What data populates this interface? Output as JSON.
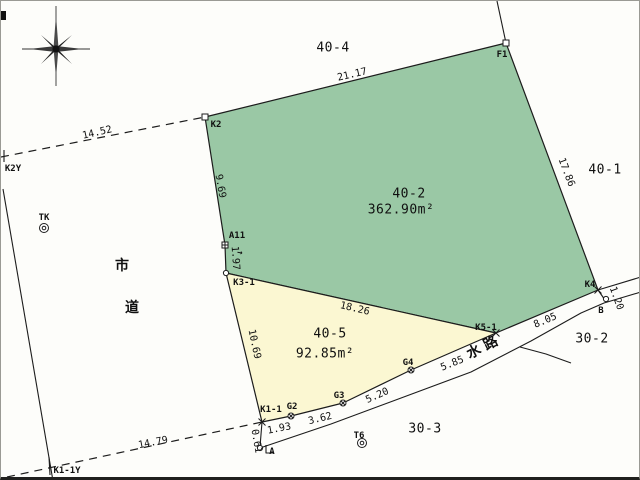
{
  "map": {
    "type_note": "cadastral survey plat",
    "colors": {
      "parcel_green": "#9ac8a5",
      "parcel_yellow": "#fbf7d2",
      "line": "#1c1c1c",
      "paper": "#fdfdfa"
    },
    "compass": {
      "cx": 55,
      "cy": 47
    },
    "parcels": [
      {
        "name": "parcel-40-2",
        "id_label": "40-2",
        "area": "362.90m²",
        "fill": "#9ac8a5",
        "points": [
          [
            204,
            116
          ],
          [
            505,
            42
          ],
          [
            597,
            289
          ],
          [
            495,
            332
          ],
          [
            225,
            272
          ],
          [
            224,
            244
          ]
        ]
      },
      {
        "name": "parcel-40-5",
        "id_label": "40-5",
        "area": "92.85m²",
        "fill": "#fbf7d2",
        "points": [
          [
            225,
            272
          ],
          [
            495,
            332
          ],
          [
            410,
            369
          ],
          [
            342,
            402
          ],
          [
            290,
            415
          ],
          [
            261,
            421
          ]
        ]
      }
    ],
    "dashed_lines": [
      {
        "name": "road-boundary-north-dashed",
        "pts": [
          [
            0,
            156
          ],
          [
            204,
            116
          ]
        ]
      },
      {
        "name": "road-boundary-south-dashed",
        "pts": [
          [
            6,
            476
          ],
          [
            261,
            421
          ]
        ]
      }
    ],
    "solid_lines": [
      {
        "name": "f1-stem-line",
        "pts": [
          [
            505,
            42
          ],
          [
            496,
            0
          ]
        ]
      },
      {
        "name": "road-left-edge",
        "pts": [
          [
            2,
            188
          ],
          [
            52,
            480
          ]
        ]
      },
      {
        "name": "waterway-top-bank-extension",
        "pts": [
          [
            597,
            289
          ],
          [
            640,
            276
          ]
        ]
      },
      {
        "name": "waterway-bottom-bank",
        "pts": [
          [
            259,
            447
          ],
          [
            330,
            423
          ],
          [
            392,
            400
          ],
          [
            470,
            371
          ],
          [
            530,
            340
          ],
          [
            580,
            312
          ],
          [
            603,
            302
          ],
          [
            640,
            291
          ]
        ]
      },
      {
        "name": "k4-to-b-segment",
        "pts": [
          [
            597,
            289
          ],
          [
            604,
            299
          ]
        ]
      },
      {
        "name": "k1-1-to-a-segment",
        "pts": [
          [
            261,
            421
          ],
          [
            259,
            446
          ]
        ]
      },
      {
        "name": "boundary-branch-30-2-30-3",
        "pts": [
          [
            519,
            346
          ],
          [
            545,
            353
          ],
          [
            570,
            362
          ]
        ]
      },
      {
        "name": "k1-1y-tick",
        "pts": [
          [
            48,
            456
          ],
          [
            49,
            474
          ]
        ]
      },
      {
        "name": "k2y-tick",
        "pts": [
          [
            3,
            149
          ],
          [
            3,
            161
          ]
        ]
      },
      {
        "name": "a-corner-bracket",
        "pts": [
          [
            265,
            444
          ],
          [
            265,
            452
          ],
          [
            272,
            452
          ]
        ]
      }
    ],
    "points": [
      {
        "name": "point-K2",
        "marker": "square",
        "x": 204,
        "y": 116
      },
      {
        "name": "point-F1",
        "marker": "square",
        "x": 505,
        "y": 42
      },
      {
        "name": "point-A11",
        "marker": "square-cross",
        "x": 224,
        "y": 244
      },
      {
        "name": "point-K3-1",
        "marker": "circle",
        "x": 225,
        "y": 272
      },
      {
        "name": "point-K4",
        "marker": "x",
        "x": 597,
        "y": 289
      },
      {
        "name": "point-K5-1",
        "marker": "x",
        "x": 495,
        "y": 332
      },
      {
        "name": "point-K1-1",
        "marker": "x",
        "x": 261,
        "y": 421
      },
      {
        "name": "point-A",
        "marker": "circle",
        "x": 259,
        "y": 447
      },
      {
        "name": "point-B",
        "marker": "circle",
        "x": 605,
        "y": 298
      },
      {
        "name": "point-G2",
        "marker": "circle-x",
        "x": 290,
        "y": 415
      },
      {
        "name": "point-G3",
        "marker": "circle-x",
        "x": 342,
        "y": 402
      },
      {
        "name": "point-G4",
        "marker": "circle-x",
        "x": 410,
        "y": 369
      },
      {
        "name": "point-TK",
        "marker": "double-circle",
        "x": 43,
        "y": 227
      },
      {
        "name": "point-T6",
        "marker": "double-circle",
        "x": 361,
        "y": 442
      }
    ],
    "labels": [
      {
        "name": "parcel-label-40-4",
        "cls": "parcel",
        "text": "40-4",
        "x": 332,
        "y": 46,
        "rot": 0
      },
      {
        "name": "distance-21-17",
        "cls": "dist",
        "text": "21.17",
        "x": 351,
        "y": 73,
        "rot": -13
      },
      {
        "name": "point-label-f1",
        "cls": "pt",
        "text": "F1",
        "x": 501,
        "y": 53,
        "rot": 0
      },
      {
        "name": "distance-17-86",
        "cls": "dist",
        "text": "17.86",
        "x": 566,
        "y": 171,
        "rot": 69
      },
      {
        "name": "parcel-label-40-1",
        "cls": "parcel",
        "text": "40-1",
        "x": 604,
        "y": 168,
        "rot": 0
      },
      {
        "name": "distance-14-52",
        "cls": "dist",
        "text": "14.52",
        "x": 96,
        "y": 131,
        "rot": -13
      },
      {
        "name": "point-label-k2y",
        "cls": "pt",
        "text": "K2Y",
        "x": 12,
        "y": 167,
        "rot": 0
      },
      {
        "name": "point-label-k2",
        "cls": "pt",
        "text": "K2",
        "x": 215,
        "y": 123,
        "rot": 0
      },
      {
        "name": "distance-9-69",
        "cls": "dist",
        "text": "9.69",
        "x": 220,
        "y": 185,
        "rot": 80
      },
      {
        "name": "point-label-a11",
        "cls": "pt",
        "text": "A11",
        "x": 236,
        "y": 234,
        "rot": 0
      },
      {
        "name": "direction-arrow",
        "cls": "pt",
        "text": "→",
        "x": 239,
        "y": 251,
        "rot": 10
      },
      {
        "name": "distance-1-97",
        "cls": "dist",
        "text": "1.97",
        "x": 235,
        "y": 257,
        "rot": 86
      },
      {
        "name": "point-label-k3-1",
        "cls": "pt",
        "text": "K3-1",
        "x": 243,
        "y": 281,
        "rot": 0
      },
      {
        "name": "point-label-tk",
        "cls": "pt",
        "text": "TK",
        "x": 43,
        "y": 216,
        "rot": 0
      },
      {
        "name": "road-name-char-1",
        "cls": "kanji",
        "text": "市",
        "x": 121,
        "y": 264,
        "rot": 0
      },
      {
        "name": "road-name-char-2",
        "cls": "kanji",
        "text": "道",
        "x": 131,
        "y": 306,
        "rot": 0
      },
      {
        "name": "parcel-label-40-2",
        "cls": "parcel",
        "text": "40-2",
        "x": 408,
        "y": 192,
        "rot": 0
      },
      {
        "name": "area-label-40-2",
        "cls": "parcel",
        "text": "362.90m²",
        "x": 400,
        "y": 208,
        "rot": 0
      },
      {
        "name": "distance-18-26",
        "cls": "dist",
        "text": "18.26",
        "x": 354,
        "y": 307,
        "rot": 13
      },
      {
        "name": "parcel-label-40-5",
        "cls": "parcel",
        "text": "40-5",
        "x": 329,
        "y": 332,
        "rot": 0
      },
      {
        "name": "area-label-40-5",
        "cls": "parcel",
        "text": "92.85m²",
        "x": 324,
        "y": 352,
        "rot": 0
      },
      {
        "name": "distance-10-69",
        "cls": "dist",
        "text": "10.69",
        "x": 254,
        "y": 343,
        "rot": 78
      },
      {
        "name": "point-label-k4",
        "cls": "pt",
        "text": "K4",
        "x": 589,
        "y": 283,
        "rot": 0
      },
      {
        "name": "distance-1-20",
        "cls": "dist",
        "text": "1.20",
        "x": 616,
        "y": 297,
        "rot": 70
      },
      {
        "name": "point-label-b",
        "cls": "pt",
        "text": "B",
        "x": 600,
        "y": 309,
        "rot": 0
      },
      {
        "name": "parcel-label-30-2",
        "cls": "parcel",
        "text": "30-2",
        "x": 591,
        "y": 337,
        "rot": 0
      },
      {
        "name": "distance-8-05",
        "cls": "dist",
        "text": "8.05",
        "x": 544,
        "y": 319,
        "rot": -23
      },
      {
        "name": "point-label-k5-1",
        "cls": "pt",
        "text": "K5-1",
        "x": 485,
        "y": 326,
        "rot": 0
      },
      {
        "name": "waterway-name",
        "cls": "kanji",
        "text": "水 路",
        "x": 481,
        "y": 346,
        "rot": -27
      },
      {
        "name": "distance-5-85",
        "cls": "dist",
        "text": "5.85",
        "x": 451,
        "y": 362,
        "rot": -22
      },
      {
        "name": "point-label-g4",
        "cls": "pt",
        "text": "G4",
        "x": 407,
        "y": 361,
        "rot": 0
      },
      {
        "name": "distance-5-20",
        "cls": "dist",
        "text": "5.20",
        "x": 376,
        "y": 394,
        "rot": -24
      },
      {
        "name": "point-label-g3",
        "cls": "pt",
        "text": "G3",
        "x": 338,
        "y": 394,
        "rot": 0
      },
      {
        "name": "distance-3-62",
        "cls": "dist",
        "text": "3.62",
        "x": 319,
        "y": 417,
        "rot": -14
      },
      {
        "name": "point-label-g2",
        "cls": "pt",
        "text": "G2",
        "x": 291,
        "y": 405,
        "rot": 0
      },
      {
        "name": "point-label-k1-1",
        "cls": "pt",
        "text": "K1-1",
        "x": 270,
        "y": 408,
        "rot": 0
      },
      {
        "name": "distance-1-93",
        "cls": "dist",
        "text": "1.93",
        "x": 278,
        "y": 427,
        "rot": -11
      },
      {
        "name": "distance-0-61",
        "cls": "dist",
        "text": "0.61",
        "x": 256,
        "y": 440,
        "rot": 80
      },
      {
        "name": "point-label-a",
        "cls": "pt",
        "text": "A",
        "x": 271,
        "y": 450,
        "rot": 0
      },
      {
        "name": "point-label-t6",
        "cls": "pt",
        "text": "T6",
        "x": 358,
        "y": 434,
        "rot": 0
      },
      {
        "name": "parcel-label-30-3",
        "cls": "parcel",
        "text": "30-3",
        "x": 424,
        "y": 427,
        "rot": 0
      },
      {
        "name": "distance-14-79",
        "cls": "dist",
        "text": "14.79",
        "x": 152,
        "y": 441,
        "rot": -11
      },
      {
        "name": "point-label-k1-1y",
        "cls": "pt",
        "text": "K1-1Y",
        "x": 66,
        "y": 469,
        "rot": 0
      }
    ]
  }
}
